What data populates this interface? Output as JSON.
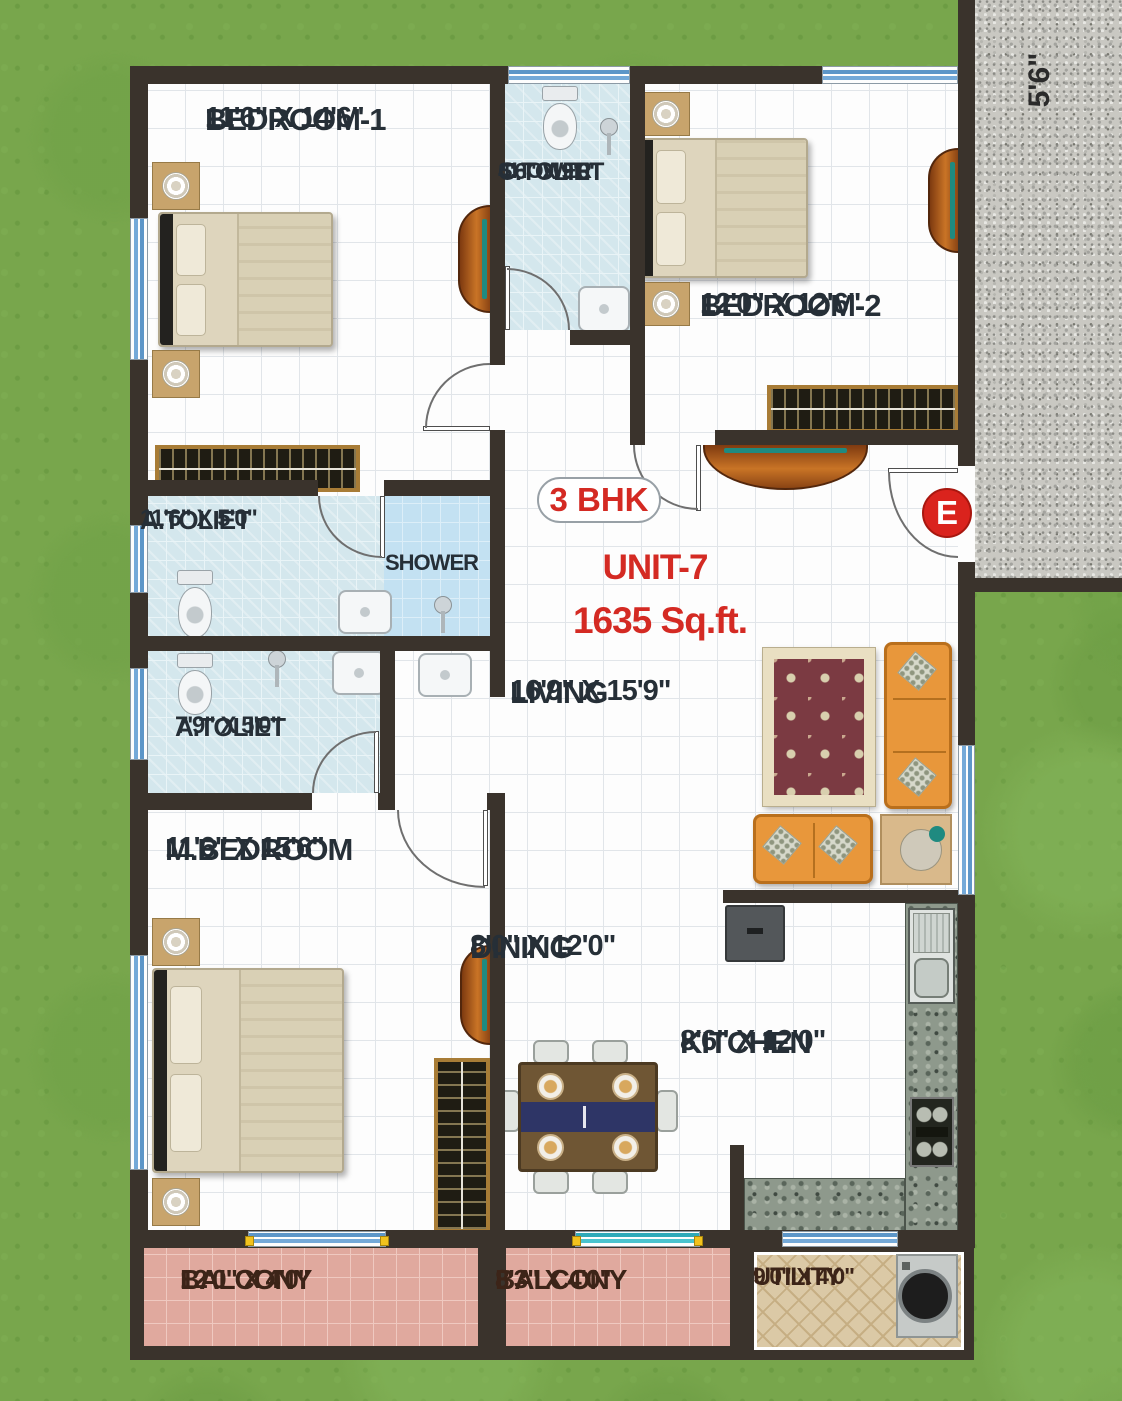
{
  "unit": {
    "type_badge": "3 BHK",
    "name": "UNIT-7",
    "area": "1635 Sq.ft.",
    "entrance": "E",
    "corridor_width": "5'6\""
  },
  "rooms": {
    "bedroom1": {
      "name": "BEDROOM-1",
      "dims": "11'6\" X 14'6\""
    },
    "c_toilet": {
      "name": "C.TOLIET",
      "dims": "4'6\" X 9'0\"",
      "note": "SHOWER"
    },
    "bedroom2": {
      "name": "BEDROOM-2",
      "dims": "12'0\" X 12'6\""
    },
    "a_toilet1": {
      "name": "A.TOLIET",
      "dims": "11'6\" X 5'0\"",
      "note": "SHOWER"
    },
    "a_toilet2": {
      "name": "A.TOLIET",
      "dims": "7'9\" X 5'0\""
    },
    "living": {
      "name": "LIVING",
      "dims": "16'9\" X 15'9\""
    },
    "m_bedroom": {
      "name": "M.BEDROOM",
      "dims": "11'6\" X 15'6\""
    },
    "dining": {
      "name": "DINING",
      "dims": "8'0\" X 12'0\""
    },
    "kitchen": {
      "name": "KITCHEN",
      "dims": "8'6\" X 12'0\""
    },
    "balcony1": {
      "name": "BALCONY",
      "dims": "12'0\" X 4'0\""
    },
    "balcony2": {
      "name": "BALCONY",
      "dims": "8'3\" X 4'0\""
    },
    "utility": {
      "name": "UTILITY",
      "dims": "9'0\" X 4'0\""
    }
  },
  "colors": {
    "wall": "#3a332c",
    "grass": "#78a64c",
    "accent_red": "#d42a23",
    "toilet_tile": "#d4e7ed",
    "balcony_tile": "#e0a99e",
    "utility_floor": "#dbc9a6",
    "granite_corridor": "#c9c8c2",
    "sofa_orange": "#e8973b"
  }
}
